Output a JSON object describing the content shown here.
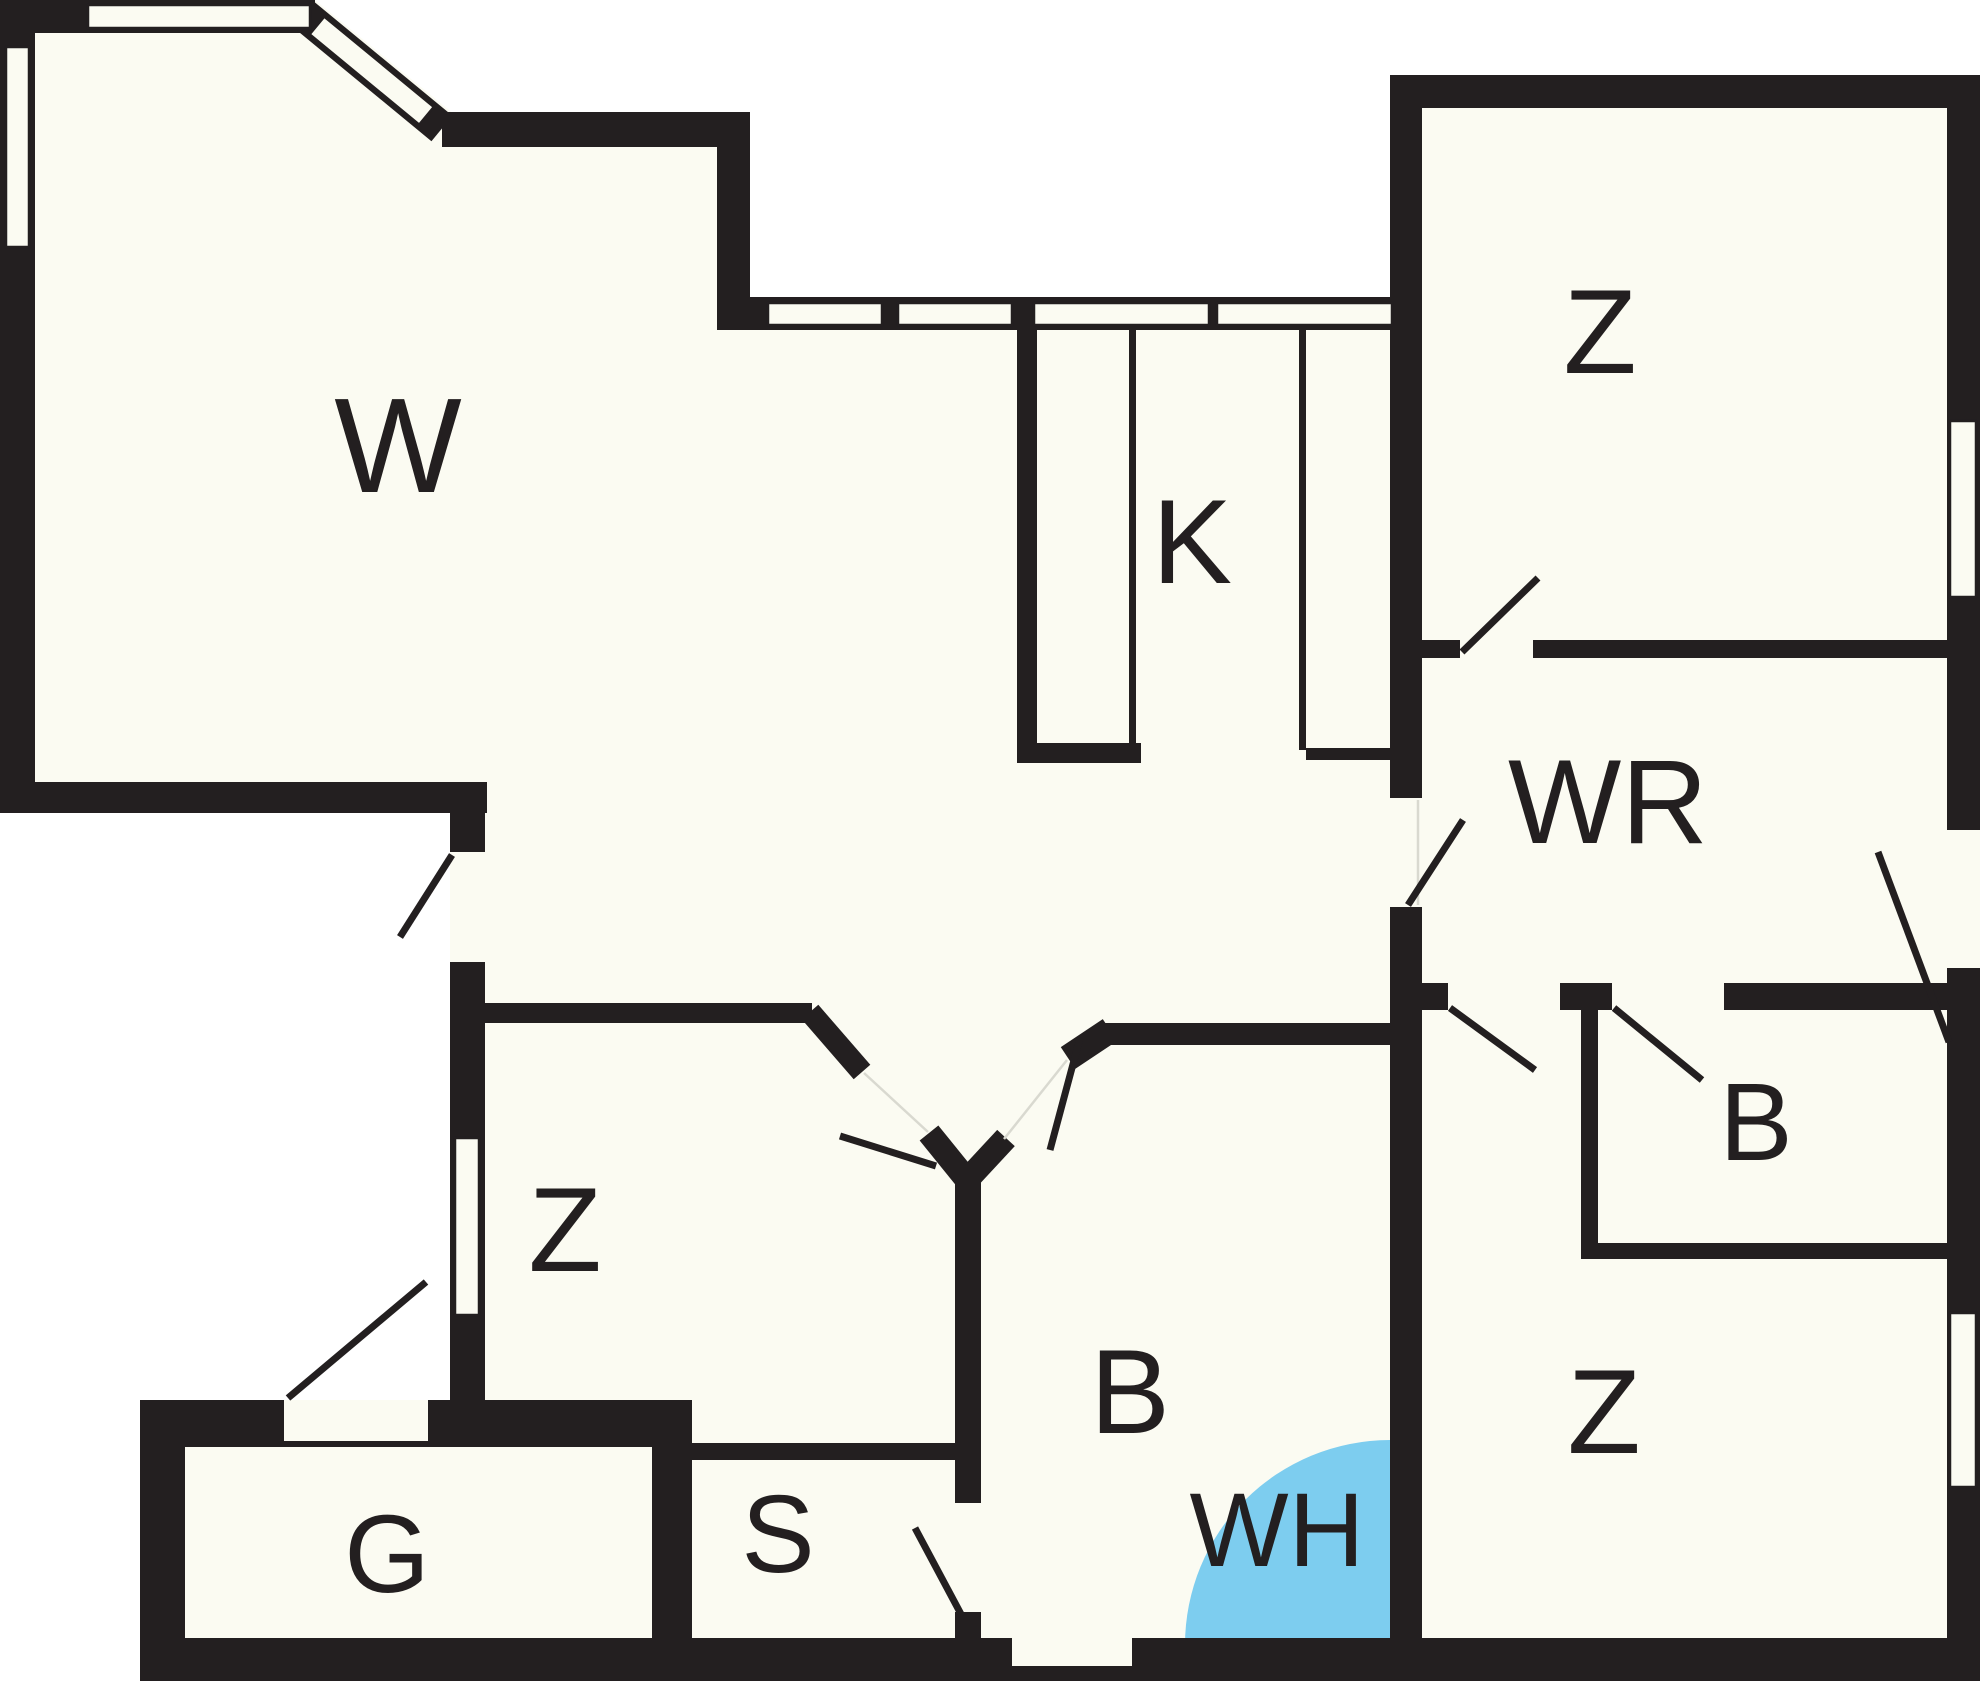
{
  "title": "Apartment floor plan",
  "colors": {
    "wall": "#231F20",
    "floor": "#FBFBF2",
    "outside": "#FFFFFF",
    "water_heater_highlight": "#7DCDEF",
    "label_text": "#231F20",
    "faint_line": "#D9D9D0"
  },
  "rooms": [
    {
      "id": "w",
      "label": "W"
    },
    {
      "id": "k",
      "label": "K"
    },
    {
      "id": "z-top-right",
      "label": "Z"
    },
    {
      "id": "wr",
      "label": "WR"
    },
    {
      "id": "b-small",
      "label": "B"
    },
    {
      "id": "z-bottom-right",
      "label": "Z"
    },
    {
      "id": "z-bottom-left",
      "label": "Z"
    },
    {
      "id": "b-bath",
      "label": "B"
    },
    {
      "id": "wh",
      "label": "WH"
    },
    {
      "id": "s",
      "label": "S"
    },
    {
      "id": "g",
      "label": "G"
    }
  ]
}
